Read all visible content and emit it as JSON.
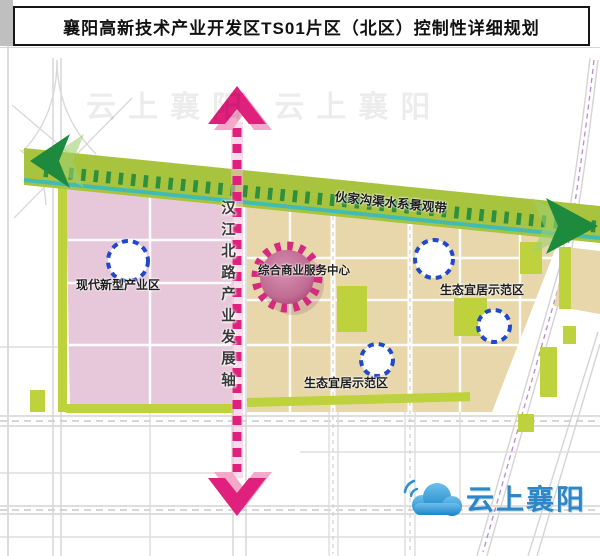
{
  "title": "襄阳高新技术产业开发区TS01片区（北区）控制性详细规划",
  "map": {
    "corridor_label": "伙家沟渠水系景观带",
    "axis_label": "汉江北路产业发展轴",
    "center_node_label": "综合商业服务中心",
    "zone_labels": {
      "industry": "现代新型产业区",
      "eco_right": "生态宜居示范区",
      "eco_bottom": "生态宜居示范区"
    },
    "ghost_watermark": "云上襄阳  云上襄阳",
    "logo_text": "云上襄阳"
  },
  "colors": {
    "zone_industry_pink": "#e7c8da",
    "zone_eco_tan": "#e7d7ab",
    "corridor_green": "#a8c33e",
    "park_green": "#bdd23c",
    "corridor_arrow_green": "#1e8a3d",
    "waterline_teal": "#40bcb4",
    "axis_magenta": "#e0207d",
    "axis_light_pink": "#f2a9ca",
    "node_ring_blue": "#1f49c8",
    "gear_ring_magenta": "#d42a80",
    "logo_blue": "#2e86c6",
    "road_gray": "#d4d4d4"
  }
}
